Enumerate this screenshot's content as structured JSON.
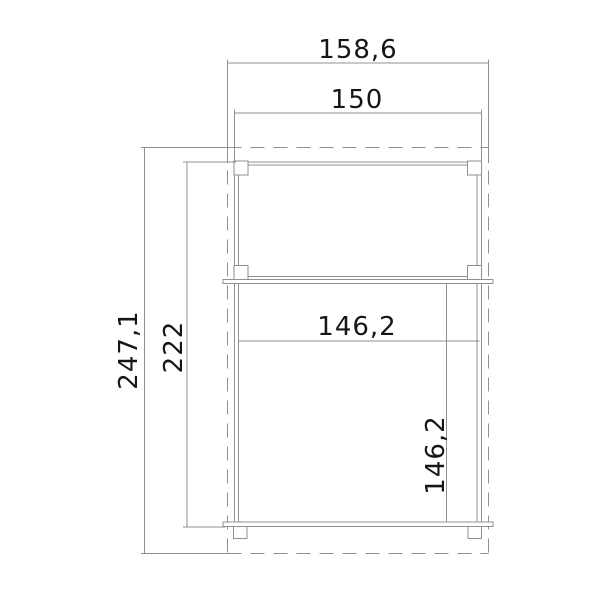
{
  "drawing": {
    "kind": "technical dimension drawing (shed/cabinet plan)",
    "colors": {
      "background": "#ffffff",
      "line": "#8d9193",
      "text": "#161616"
    },
    "dimensions": {
      "overall_width": "158,6",
      "frame_width": "150",
      "overall_height": "247,1",
      "frame_height": "222",
      "inner_width": "146,2",
      "inner_height": "146,2"
    }
  }
}
